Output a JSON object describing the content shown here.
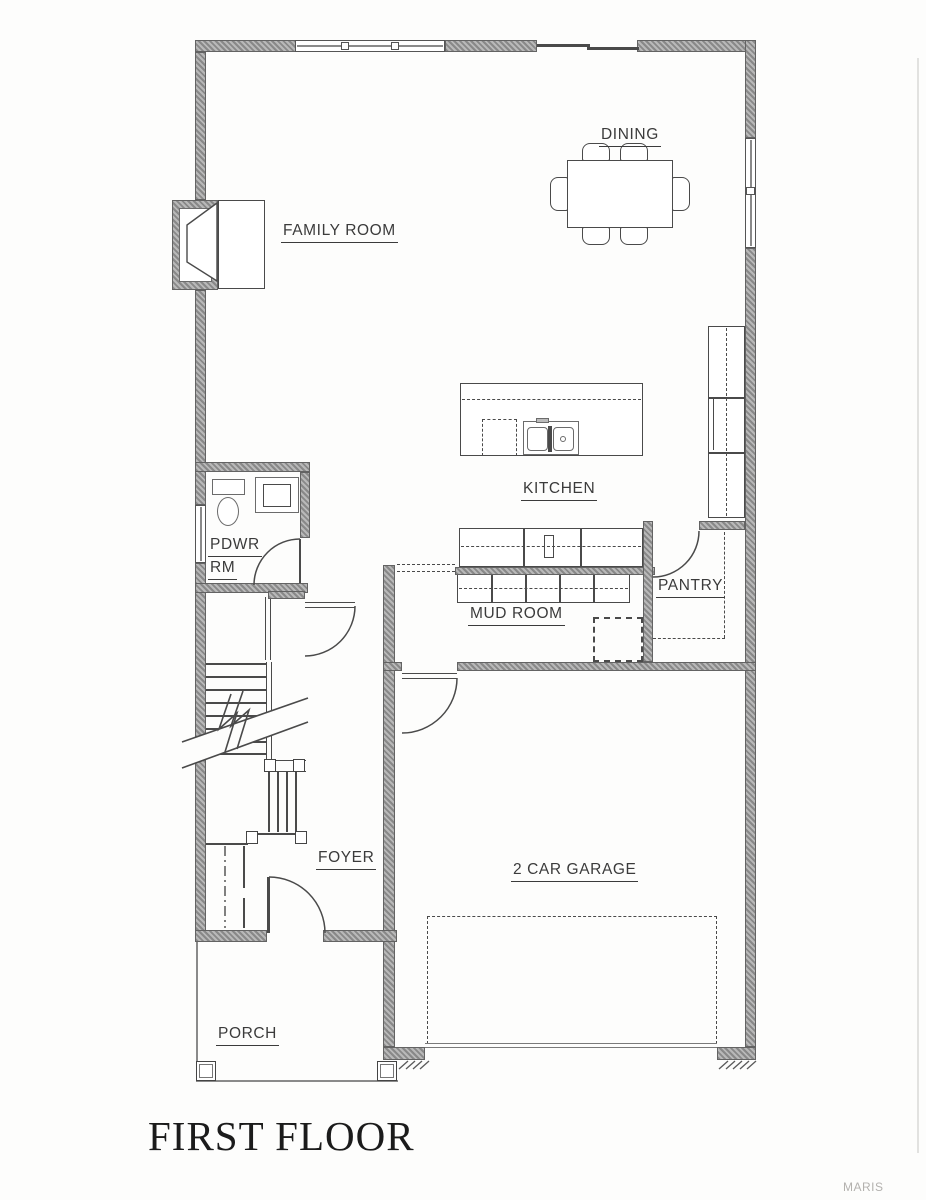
{
  "title": "FIRST FLOOR",
  "watermark": "MARIS",
  "rooms": {
    "dining": "DINING",
    "family": "FAMILY ROOM",
    "kitchen": "KITCHEN",
    "pdwr_line1": "PDWR",
    "pdwr_line2": "RM",
    "mud": "MUD ROOM",
    "pantry": "PANTRY",
    "foyer": "FOYER",
    "garage": "2 CAR GARAGE",
    "porch": "PORCH"
  },
  "colors": {
    "wall_fill": "#a9a9a9",
    "line": "#4a4a4a",
    "text": "#3b3b3b",
    "paper": "#fdfdfc",
    "watermark": "#b3b1ae"
  }
}
